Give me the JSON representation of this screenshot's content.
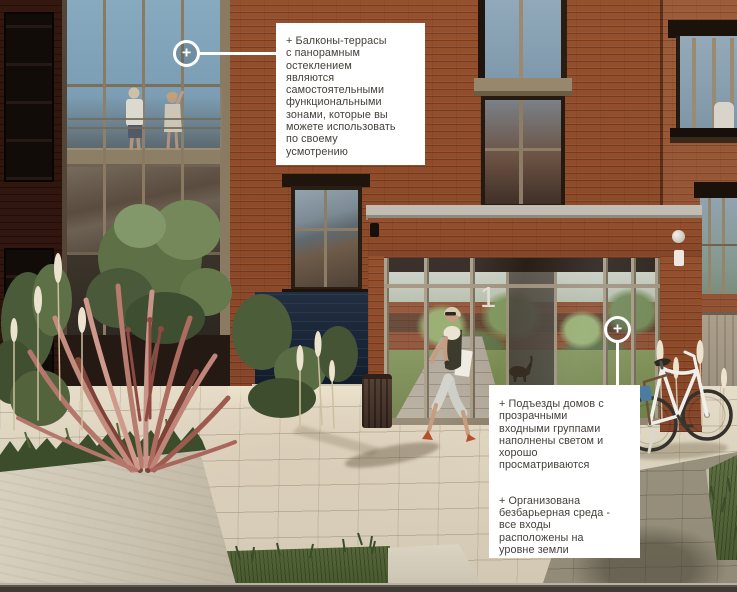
{
  "entrance": {
    "number": "1"
  },
  "annotations": {
    "marker_symbol": "+",
    "callout_1": {
      "lines": [
        "+ Балконы-террасы",
        "с панорамным",
        "остеклением",
        "являются",
        "самостоятельными",
        "функциональными",
        "зонами, которые вы",
        "можете использовать",
        "по своему",
        "усмотрению"
      ]
    },
    "callout_2": {
      "paragraph_1": {
        "lines": [
          "+ Подъезды домов с",
          "прозрачными",
          "входными группами",
          "наполнены светом и",
          "хорошо",
          "просматриваются"
        ]
      },
      "paragraph_2": {
        "lines": [
          "+ Организована",
          "безбарьерная среда -",
          "все входы",
          "расположены на",
          "уровне земли"
        ]
      }
    }
  },
  "colors": {
    "brick": "#95512e",
    "brick_shadow": "#2f150d",
    "glass_sky": "#7fa3b8",
    "plinth_navy": "#182435",
    "paving": "#ddd3bf",
    "paving_shadow": "#958e7b",
    "concrete": "#cfc8b7",
    "greenery": "#5d7046",
    "pink_grass": "#bc8176",
    "callout_bg": "#ffffff",
    "callout_text": "#44403b",
    "marker_ring": "#ffffff"
  }
}
